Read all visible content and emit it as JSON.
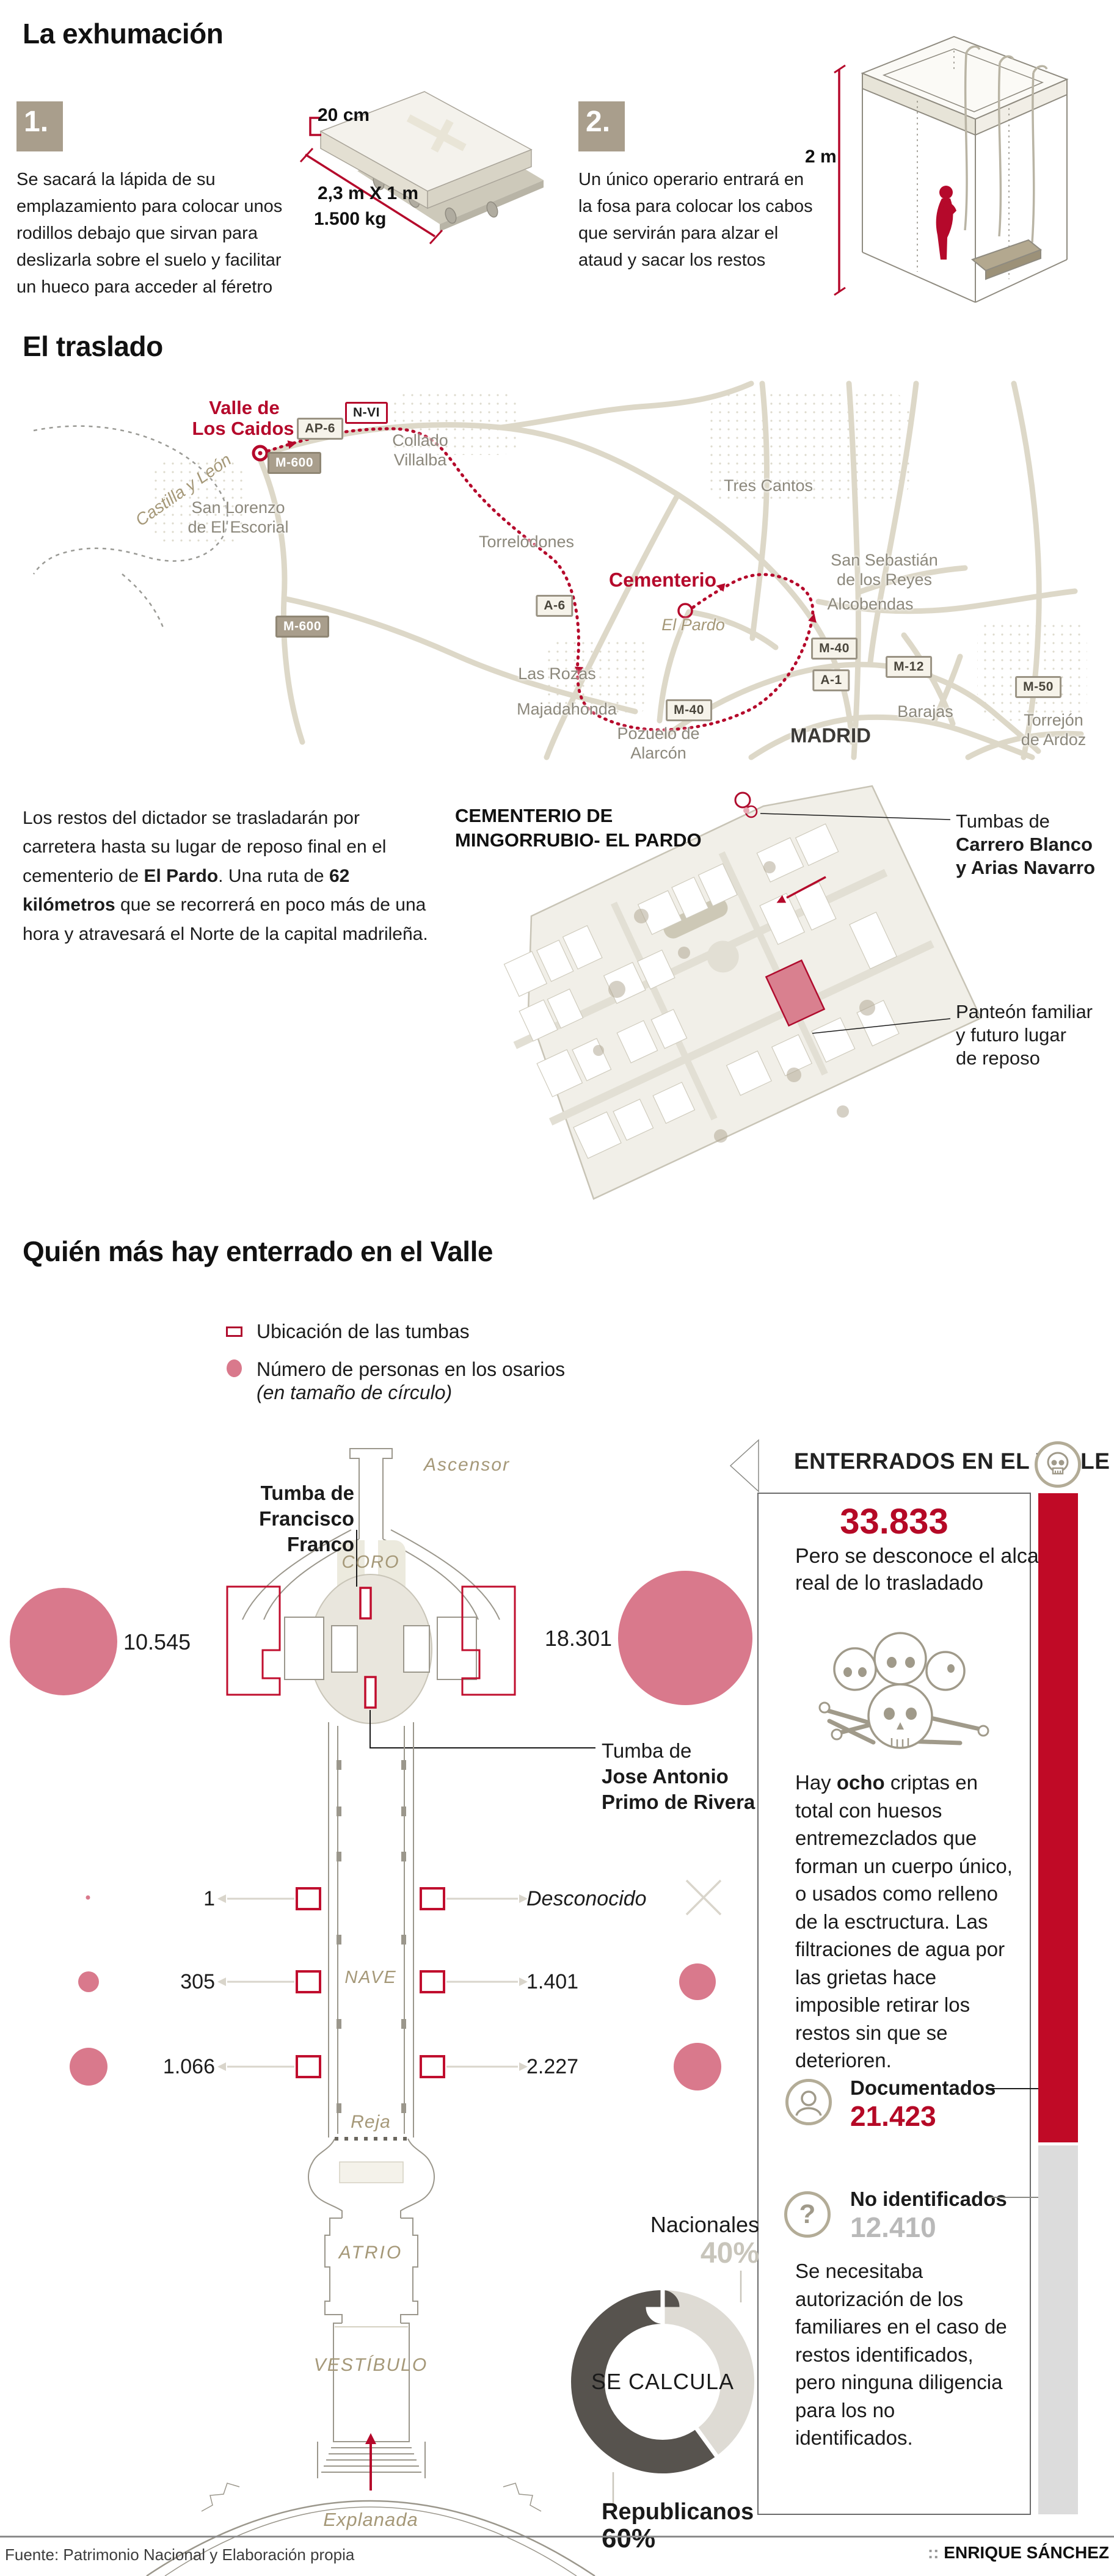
{
  "exhumacion": {
    "title": "La exhumación",
    "steps": [
      {
        "num": "1.",
        "text": "Se sacará la lápida de su emplazamiento para colocar unos rodillos debajo que sirvan para deslizarla sobre el suelo y facilitar un hueco para acceder al féretro"
      },
      {
        "num": "2.",
        "text": "Un único operario entrará en la fosa para colocar los cabos que servirán para alzar el ataud y sacar los restos"
      }
    ],
    "slab": {
      "thickness": "20 cm",
      "size": "2,3 m X 1 m",
      "weight": "1.500 kg"
    },
    "pit_depth": "2 m"
  },
  "traslado": {
    "title": "El traslado",
    "para": {
      "p1": "Los restos del dictador se trasladarán por carretera hasta su lugar de reposo final en el cementerio de ",
      "b1": "El Pardo",
      "p2": ". Una ruta de ",
      "b2": "62 kilómetros",
      "p3": " que se recorrerá en poco más de una hora y atravesará el Norte de la capital madrileña."
    },
    "map": {
      "origin_l1": "Valle de",
      "origin_l2": "Los Caidos",
      "destination": "Cementerio",
      "region": "Castilla y León",
      "shields": {
        "nvi": "N-VI",
        "ap6": "AP-6",
        "m600": "M-600",
        "a6": "A-6",
        "m40": "M-40",
        "a1": "A-1",
        "m12": "M-12",
        "m50": "M-50"
      },
      "places": {
        "collado_l1": "Collado",
        "collado_l2": "Villalba",
        "sanlorenzo_l1": "San Lorenzo",
        "sanlorenzo_l2": "de El Escorial",
        "torrelodones": "Torrelodones",
        "trescantos": "Tres Cantos",
        "elpardo": "El Pardo",
        "sansebastian_l1": "San Sebastián",
        "sansebastian_l2": "de los Reyes",
        "alcobendas": "Alcobendas",
        "lasrozas": "Las Rozas",
        "majadahonda": "Majadahonda",
        "pozuelo_l1": "Pozuelo de",
        "pozuelo_l2": "Alarcón",
        "barajas": "Barajas",
        "madrid": "MADRID",
        "torrejon_l1": "Torrejón",
        "torrejon_l2": "de Ardoz"
      }
    }
  },
  "cementerio": {
    "title_l1": "CEMENTERIO DE",
    "title_l2": "MINGORRUBIO- EL PARDO",
    "tumbas_l1": "Tumbas de",
    "tumbas_l2": "Carrero Blanco",
    "tumbas_l3": "y Arias Navarro",
    "panteon_l1": "Panteón familiar",
    "panteon_l2": "y futuro lugar",
    "panteon_l3": "de reposo"
  },
  "valle": {
    "title": "Quién más hay enterrado en el Valle",
    "legend_tumbas": "Ubicación de las tumbas",
    "legend_osarios": "Número de personas en los osarios",
    "legend_osarios_note": "(en tamaño de círculo)",
    "plan": {
      "ascensor": "Ascensor",
      "coro": "CORO",
      "nave": "NAVE",
      "reja": "Reja",
      "atrio": "ATRIO",
      "vestibulo": "VESTÍBULO",
      "explanada": "Explanada"
    },
    "tumba_franco_l1": "Tumba de",
    "tumba_franco_l2": "Francisco Franco",
    "tumba_ja_l1": "Tumba de",
    "tumba_ja_l2": "Jose Antonio",
    "tumba_ja_l3": "Primo de Rivera",
    "osarios": {
      "left_top": "10.545",
      "right_top": "18.301",
      "r1l": "1",
      "r1r": "Desconocido",
      "r2l": "305",
      "r2r": "1.401",
      "r3l": "1.066",
      "r3r": "2.227"
    }
  },
  "panel": {
    "header": "ENTERRADOS EN EL VALLE",
    "total": "33.833",
    "total_note_l1": "Pero se desconoce el alcance",
    "total_note_l2": "real de lo trasladado",
    "criptas_p1": "Hay ",
    "criptas_b": "ocho",
    "criptas_p2": " criptas en total con huesos entremezclados que forman un cuerpo único, o usados como relleno de la esctructura. Las filtraciones de agua por las grietas hace imposible retirar los restos sin que se deterioren.",
    "doc_label": "Documentados",
    "doc_value": "21.423",
    "noid_label": "No identificados",
    "noid_value": "12.410",
    "nota": "Se necesitaba autorización de los familiares en el caso de restos identificados, pero ninguna diligencia para los no identificados."
  },
  "donut": {
    "label_top": "Nacionales",
    "pct_top": "40%",
    "center": "SE CALCULA",
    "label_bottom": "Republicanos",
    "pct_bottom": "60%"
  },
  "footer": {
    "source": "Fuente: Patrimonio Nacional y Elaboración propia",
    "credit_sep": "::",
    "credit": "ENRIQUE SÁNCHEZ"
  },
  "colors": {
    "accent_red": "#b5092b",
    "bar_red": "#c00a26",
    "bar_gray": "#dcdcdc",
    "pink": "#d9798c",
    "taupe": "#a99e8c",
    "donut_dark": "#57534e",
    "donut_light": "#dedbd4"
  },
  "chart_data": [
    {
      "type": "pie",
      "donut": true,
      "title": "SE CALCULA",
      "labels": [
        "Nacionales",
        "Republicanos"
      ],
      "values": [
        40,
        60
      ],
      "unit": "%",
      "colors": [
        "#dedbd4",
        "#57534e"
      ],
      "legend_position": "outside"
    },
    {
      "type": "scatter",
      "title": "Número de personas en los osarios (en tamaño de círculo)",
      "points": [
        {
          "label": "Crucero izquierda",
          "value": 10545
        },
        {
          "label": "Crucero derecha",
          "value": 18301
        },
        {
          "label": "Nave izquierda fila 1",
          "value": 1
        },
        {
          "label": "Nave derecha fila 1",
          "value": "Desconocido"
        },
        {
          "label": "Nave izquierda fila 2",
          "value": 305
        },
        {
          "label": "Nave derecha fila 2",
          "value": 1401
        },
        {
          "label": "Nave izquierda fila 3",
          "value": 1066
        },
        {
          "label": "Nave derecha fila 3",
          "value": 2227
        }
      ]
    },
    {
      "type": "bar",
      "title": "ENTERRADOS EN EL VALLE",
      "categories": [
        "Total enterrados",
        "Documentados",
        "No identificados"
      ],
      "values": [
        33833,
        21423,
        12410
      ]
    }
  ]
}
